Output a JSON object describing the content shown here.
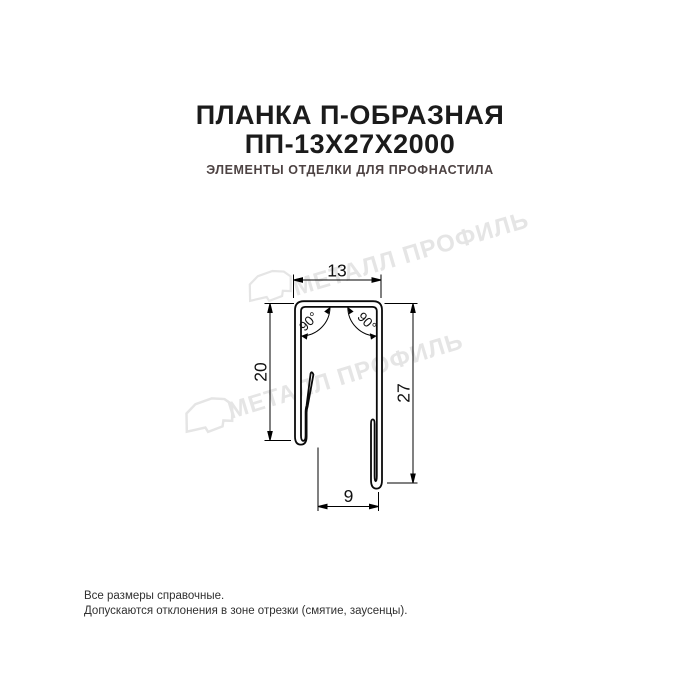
{
  "header": {
    "title_line1": "ПЛАНКА П-ОБРАЗНАЯ",
    "title_line2": "ПП-13Х27Х2000",
    "subtitle": "ЭЛЕМЕНТЫ ОТДЕЛКИ ДЛЯ ПРОФНАСТИЛА",
    "title_color": "#1b1b1b",
    "subtitle_color": "#4d4343"
  },
  "drawing": {
    "dims": {
      "top_width": "13",
      "left_height": "20",
      "right_height": "27",
      "bottom_width": "9"
    },
    "angles": {
      "left": "90°",
      "right": "90°"
    },
    "line_color": "#000000"
  },
  "watermark": {
    "text": "МЕТАЛЛ ПРОФИЛЬ",
    "color": "#e5e5e5"
  },
  "footer": {
    "note_line1": "Все размеры справочные.",
    "note_line2": "Допускаются отклонения в зоне отрезки (смятие, заусенцы).",
    "color": "#303030"
  }
}
